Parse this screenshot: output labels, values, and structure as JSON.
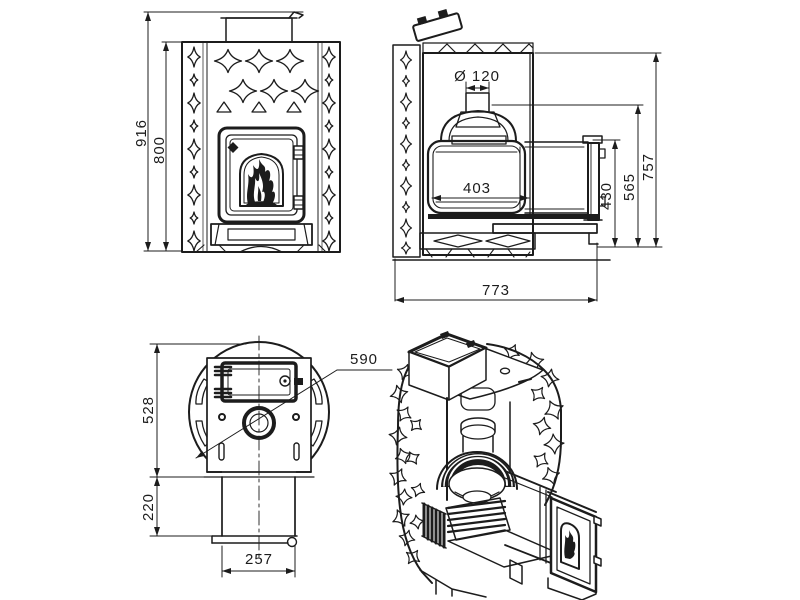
{
  "colors": {
    "background": "#ffffff",
    "line": "#1c1c1c"
  },
  "views": {
    "front": {
      "dimensions": {
        "overall_height": "916",
        "body_height": "800"
      }
    },
    "side_section": {
      "dimensions": {
        "chimney_diameter": "Ø 120",
        "firebox_depth": "403",
        "total_depth": "773",
        "height_total": "757",
        "height_chimney_top": "565",
        "height_firebox_top": "430"
      }
    },
    "top": {
      "dimensions": {
        "shell_diameter": "590",
        "body_depth": "528",
        "tunnel_length": "220",
        "tunnel_width": "257"
      }
    }
  }
}
